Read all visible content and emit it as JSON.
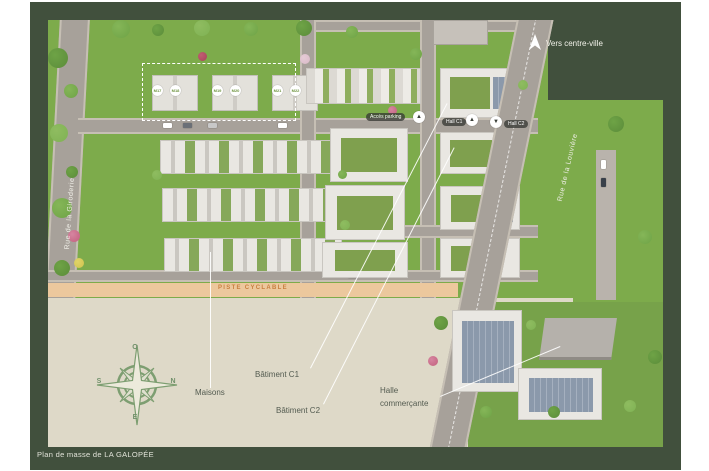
{
  "caption": "Plan de masse de LA GALOPÉE",
  "streets": {
    "left": "Rue de la Giroderie",
    "right": "Rue de la Louvière",
    "bike_path": "PISTE CYCLABLE"
  },
  "wayfinding": {
    "centre_ville": "Vers centre-ville",
    "acces_parking": "Accès parking",
    "hall_c1": "Hall C1",
    "hall_c2": "Hall C2"
  },
  "icons": {
    "up_arrow": "▲",
    "down_arrow": "▼"
  },
  "compass": {
    "top": "O",
    "right": "N",
    "bottom": "E",
    "left": "S"
  },
  "callouts": {
    "maisons": "Maisons",
    "batiment_c1": "Bâtiment C1",
    "batiment_c2": "Bâtiment C2",
    "halle_line1": "Halle",
    "halle_line2": "commerçante"
  },
  "lot_badges": [
    "M17",
    "M18",
    "M19",
    "M20",
    "M21",
    "M22"
  ],
  "colors": {
    "border_green": "#41503d",
    "grass": "#7dab4b",
    "plaza": "#ded9c8",
    "road": "#a7a19a",
    "bike_path": "#ecc89d",
    "bike_text": "#c97f3f",
    "callout_text": "#535b50",
    "caption_text": "#e3e4da"
  }
}
